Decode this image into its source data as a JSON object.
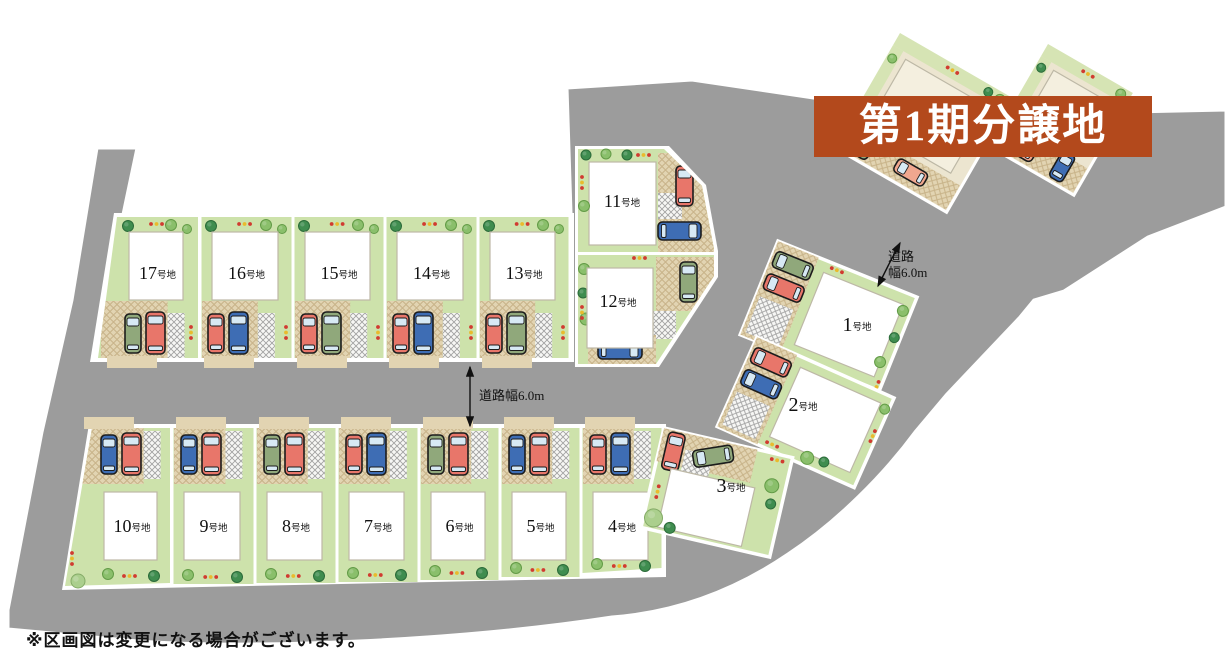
{
  "banner": {
    "label": "第1期分譲地",
    "bg_color": "#b3491c",
    "text_color": "#ffffff"
  },
  "note": "※区画図は変更になる場合がございます。",
  "road_labels": {
    "center": "道路幅6.0m",
    "right_line1": "道路",
    "right_line2": "幅6.0m"
  },
  "colors": {
    "road": "#9c9c9c",
    "lawn": "#cde2ab",
    "pad_tan": "#e2d4b2",
    "pad_line": "#c8b389",
    "house": "#ffffff",
    "house_stroke": "#bdb8a6",
    "tree_dark": "#3f8d4f",
    "tree_light": "#8abf6b",
    "bush": "#abcf8d",
    "flower_red": "#d13b30",
    "flower_yellow": "#e9bb2c",
    "car_red": "#e8766a",
    "car_blue": "#3e6db4",
    "car_green": "#90a87b",
    "car_salmon": "#f0a78f",
    "existing_lot_beige": "#ece5d0",
    "existing_house": "#f4efdf"
  },
  "lots": [
    {
      "id": "1",
      "label": "1号地",
      "num": "1",
      "suffix": "号地",
      "cars": [
        "green",
        "red"
      ]
    },
    {
      "id": "2",
      "label": "2号地",
      "num": "2",
      "suffix": "号地",
      "cars": [
        "red",
        "blue"
      ]
    },
    {
      "id": "3",
      "label": "3号地",
      "num": "3",
      "suffix": "号地",
      "cars": [
        "red",
        "green"
      ]
    },
    {
      "id": "4",
      "label": "4号地",
      "num": "4",
      "suffix": "号地",
      "cars": [
        "red",
        "blue"
      ]
    },
    {
      "id": "5",
      "label": "5号地",
      "num": "5",
      "suffix": "号地",
      "cars": [
        "blue",
        "red"
      ]
    },
    {
      "id": "6",
      "label": "6号地",
      "num": "6",
      "suffix": "号地",
      "cars": [
        "green",
        "red"
      ]
    },
    {
      "id": "7",
      "label": "7号地",
      "num": "7",
      "suffix": "号地",
      "cars": [
        "red",
        "blue"
      ]
    },
    {
      "id": "8",
      "label": "8号地",
      "num": "8",
      "suffix": "号地",
      "cars": [
        "green",
        "red"
      ]
    },
    {
      "id": "9",
      "label": "9号地",
      "num": "9",
      "suffix": "号地",
      "cars": [
        "blue",
        "red"
      ]
    },
    {
      "id": "10",
      "label": "10号地",
      "num": "10",
      "suffix": "号地",
      "cars": [
        "blue",
        "red"
      ]
    },
    {
      "id": "11",
      "label": "11号地",
      "num": "11",
      "suffix": "号地",
      "cars": [
        "red",
        "blue"
      ]
    },
    {
      "id": "12",
      "label": "12号地",
      "num": "12",
      "suffix": "号地",
      "cars": [
        "green",
        "blue"
      ]
    },
    {
      "id": "13",
      "label": "13号地",
      "num": "13",
      "suffix": "号地",
      "cars": [
        "red",
        "green"
      ]
    },
    {
      "id": "14",
      "label": "14号地",
      "num": "14",
      "suffix": "号地",
      "cars": [
        "red",
        "blue"
      ]
    },
    {
      "id": "15",
      "label": "15号地",
      "num": "15",
      "suffix": "号地",
      "cars": [
        "red",
        "green"
      ]
    },
    {
      "id": "16",
      "label": "16号地",
      "num": "16",
      "suffix": "号地",
      "cars": [
        "red",
        "blue"
      ]
    },
    {
      "id": "17",
      "label": "17号地",
      "num": "17",
      "suffix": "号地",
      "cars": [
        "green",
        "red"
      ]
    }
  ]
}
